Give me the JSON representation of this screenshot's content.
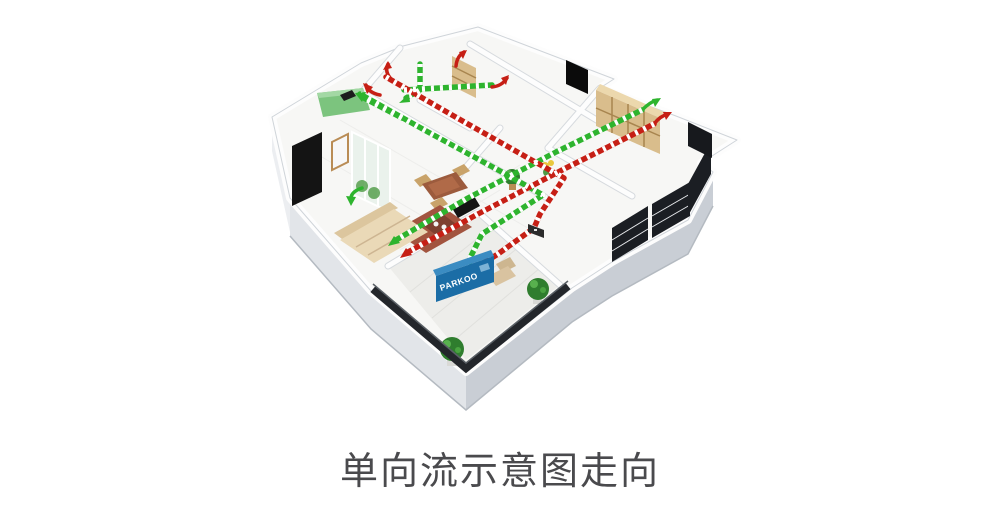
{
  "caption": {
    "text": "单向流示意图走向"
  },
  "diagram": {
    "unit_label": "PARKOO",
    "colors": {
      "supply": "#2eb42e",
      "exhaust": "#c61f15",
      "unit_blue": "#1b6da6",
      "unit_blue_top": "#3b8cc2",
      "kitchen_green": "#7cc47e",
      "wood": "#d9bd8c",
      "wood_light": "#ecd8ad",
      "plant_green": "#2f7d2e",
      "railing_dark": "#23262b",
      "sofa_beige": "#ead9b7",
      "rug_brown": "#a2543f",
      "caption_gray": "#4a4a4d"
    }
  }
}
